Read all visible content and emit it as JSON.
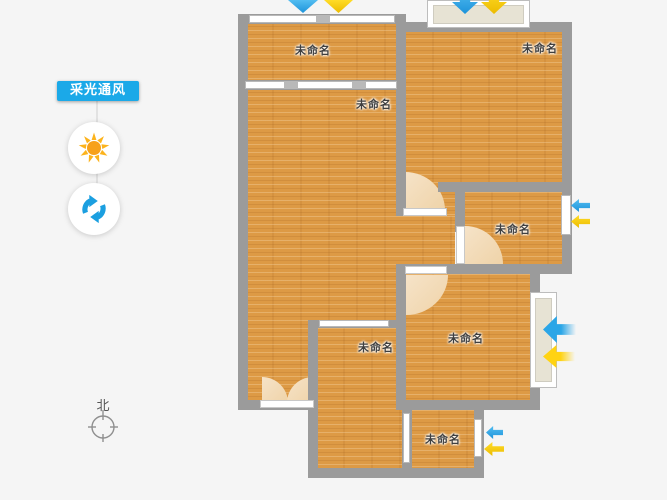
{
  "app": {
    "background_color": "#f5f5f5"
  },
  "sidebar": {
    "badge_label": "采光通风",
    "badge_color": "#1ba9e8",
    "tools": [
      {
        "id": "daylight",
        "icon": "sun-icon",
        "color": "#f9a61a"
      },
      {
        "id": "ventilation",
        "icon": "refresh-icon",
        "color": "#1b9fe0"
      }
    ]
  },
  "compass": {
    "label": "北"
  },
  "floorplan": {
    "wall_color": "#9b9b9b",
    "floor_color": "#dd9a45",
    "door_arc_color": "#f2d9b8",
    "window_color": "#ffffff",
    "rooms": [
      {
        "id": "room-top-left",
        "label": "未命名"
      },
      {
        "id": "room-living",
        "label": "未命名"
      },
      {
        "id": "room-top-right",
        "label": "未命名"
      },
      {
        "id": "room-mid-right-small",
        "label": "未命名"
      },
      {
        "id": "room-mid-right-large",
        "label": "未命名"
      },
      {
        "id": "room-bottom-middle",
        "label": "未命名"
      },
      {
        "id": "room-bottom-right",
        "label": "未命名"
      }
    ],
    "flow_arrows": {
      "wind_color": "#2ba6e7",
      "light_color": "#ffd312",
      "pairs": [
        {
          "at": "top-left-room-top",
          "direction": "down"
        },
        {
          "at": "top-right-bay-window",
          "direction": "down"
        },
        {
          "at": "mid-right-small-window",
          "direction": "left"
        },
        {
          "at": "mid-right-large-window",
          "direction": "left"
        },
        {
          "at": "bottom-right-window",
          "direction": "left"
        }
      ]
    }
  }
}
